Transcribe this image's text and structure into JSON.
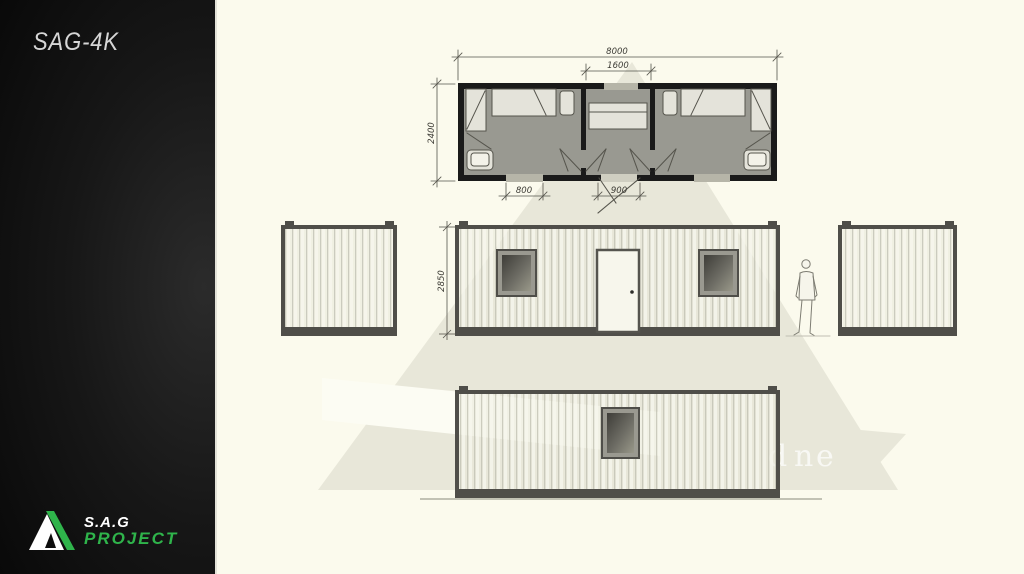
{
  "sidebar": {
    "title": "SAG-4K",
    "logo": {
      "name": "S.A.G",
      "subtitle": "PROJECT"
    }
  },
  "drawing": {
    "floor_plan": {
      "dim_overall": "8000",
      "dim_hall": "1600",
      "dim_depth": "2400",
      "dim_window": "800",
      "dim_door": "900"
    },
    "front_elevation": {
      "dim_height": "2850"
    },
    "watermark_text": "dne"
  },
  "colors": {
    "accent_green": "#2fb44b",
    "canvas_background": "#fbfaed",
    "sidebar_background": "#0a0a0a",
    "plan_wall": "#1a1a1a",
    "elevation_frame": "#4f4e49",
    "watermark_gray": "#e8e7d9"
  }
}
